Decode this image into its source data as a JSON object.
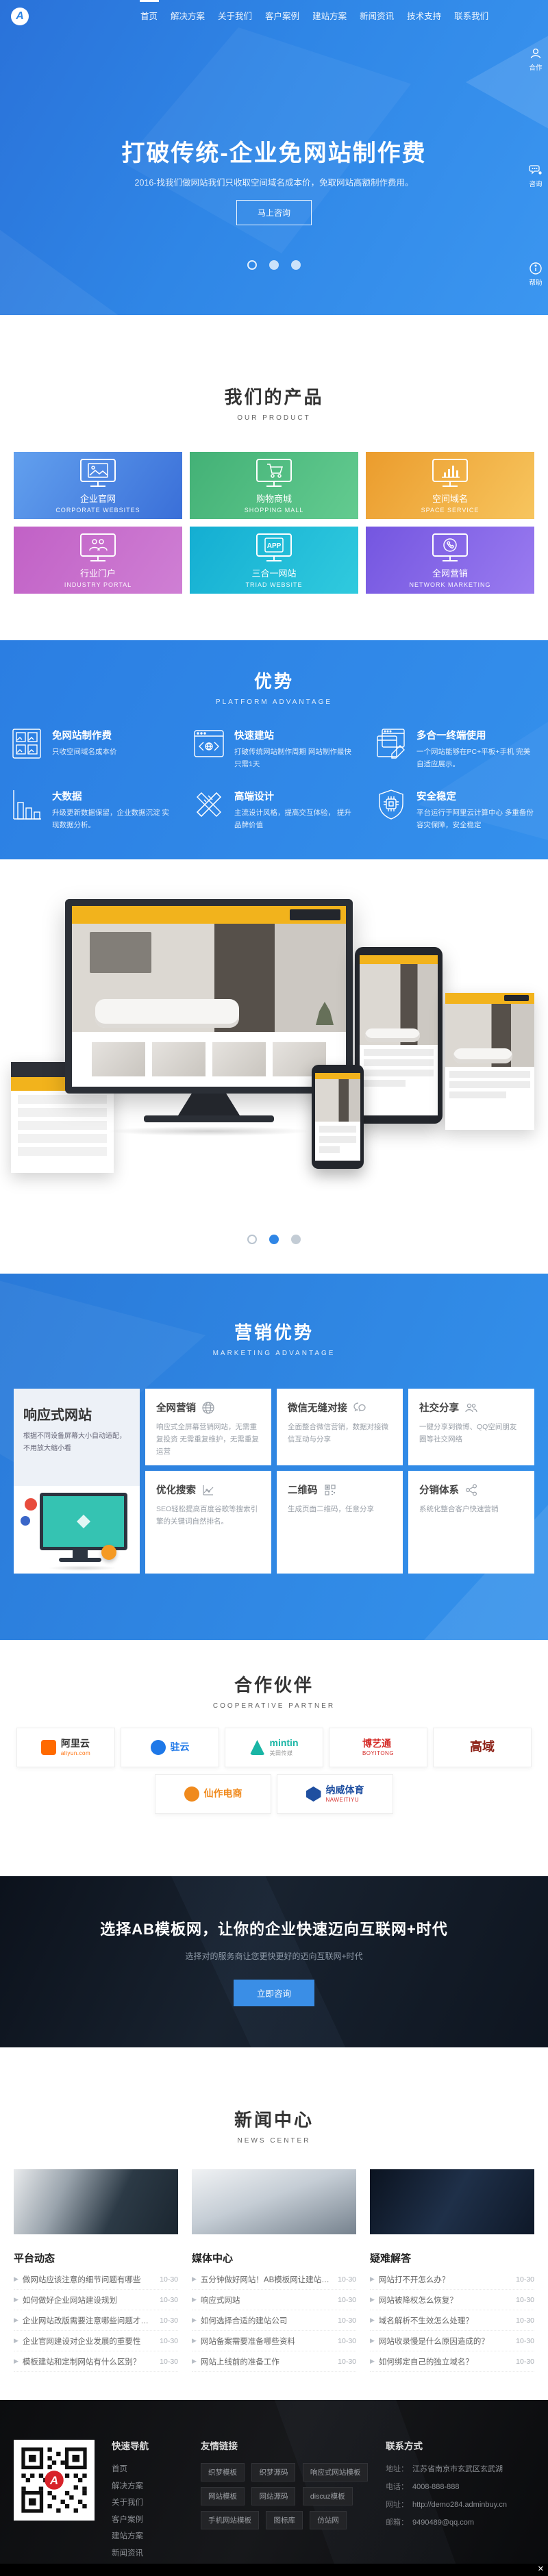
{
  "colors": {
    "primary": "#2f86e6",
    "accent_yellow": "#f2b31c",
    "cta_button": "#3a8ee6",
    "dark_footer": "#121316"
  },
  "header": {
    "logo_letter": "A",
    "nav": [
      {
        "label": "首页",
        "active": true
      },
      {
        "label": "解决方案",
        "active": false
      },
      {
        "label": "关于我们",
        "active": false
      },
      {
        "label": "客户案例",
        "active": false
      },
      {
        "label": "建站方案",
        "active": false
      },
      {
        "label": "新闻资讯",
        "active": false
      },
      {
        "label": "技术支持",
        "active": false
      },
      {
        "label": "联系我们",
        "active": false
      }
    ]
  },
  "side_toolbar": {
    "items": [
      {
        "icon": "user-icon",
        "label": "合作"
      },
      {
        "icon": "chat-icon",
        "label": "咨询"
      },
      {
        "icon": "info-icon",
        "label": "帮助"
      }
    ]
  },
  "hero": {
    "title": "打破传统-企业免网站制作费",
    "subtitle": "2016-找我们做网站我们只收取空间域名成本价，免取网站高额制作费用。",
    "cta": "马上咨询"
  },
  "products": {
    "title": "我们的产品",
    "subtitle": "OUR PRODUCT",
    "app_icon_label": "APP",
    "items": [
      {
        "zh": "企业官网",
        "en": "CORPORATE WEBSITES",
        "gradient": "linear-gradient(125deg,#62a0ee,#3a6fd8)"
      },
      {
        "zh": "购物商城",
        "en": "SHOPPING MALL",
        "gradient": "linear-gradient(125deg,#43b176,#63cb90)"
      },
      {
        "zh": "空间域名",
        "en": "SPACE SERVICE",
        "gradient": "linear-gradient(125deg,#eb9c2d,#f7c55e)"
      },
      {
        "zh": "行业门户",
        "en": "INDUSTRY PORTAL",
        "gradient": "linear-gradient(125deg,#c161c6,#cf7fd4)"
      },
      {
        "zh": "三合一网站",
        "en": "TRIAD WEBSITE",
        "gradient": "linear-gradient(125deg,#14aed2,#30cade)"
      },
      {
        "zh": "全网营销",
        "en": "NETWORK MARKETING",
        "gradient": "linear-gradient(125deg,#7456e0,#9a7bf0)"
      }
    ]
  },
  "advantages": {
    "title": "优势",
    "subtitle": "PLATFORM ADVANTAGE",
    "items": [
      {
        "title": "免网站制作费",
        "desc": "只收空间域名成本价"
      },
      {
        "title": "快速建站",
        "desc": "打破传统网站制作周期 网站制作最快只需1天"
      },
      {
        "title": "多合一终端使用",
        "desc": "一个网站能够在PC+平板+手机 完美自适应展示。"
      },
      {
        "title": "大数据",
        "desc": "升级更新数据保留，企业数据沉淀 实现数据分析。"
      },
      {
        "title": "高端设计",
        "desc": "主流设计风格，提高交互体验， 提升品牌价值"
      },
      {
        "title": "安全稳定",
        "desc": "平台运行于阿里云计算中心 多重备份容灾保障，安全稳定"
      }
    ]
  },
  "marketing": {
    "title": "营销优势",
    "subtitle": "MARKETING ADVANTAGE",
    "feature": {
      "title": "响应式网站",
      "desc": "根据不同设备屏幕大小自动适配，不用放大缩小看"
    },
    "cards": [
      {
        "icon": "globe-icon",
        "title": "全网营销",
        "desc": "响应式全屏幕营销网站，无需重复投资 无需重复维护，无需重复运营"
      },
      {
        "icon": "wechat-icon",
        "title": "微信无缝对接",
        "desc": "全面整合微信营销，数据对接微信互动与分享"
      },
      {
        "icon": "users-icon",
        "title": "社交分享",
        "desc": "一键分享到微博、QQ空间朋友圈等社交网络"
      },
      {
        "icon": "chart-line-icon",
        "title": "优化搜索",
        "desc": "SEO轻松提高百度谷歌等搜索引擎的关键词自然排名。"
      },
      {
        "icon": "qrcode-icon",
        "title": "二维码",
        "desc": "生成页面二维码，任意分享"
      },
      {
        "icon": "share-icon",
        "title": "分销体系",
        "desc": "系统化整合客户快速营销"
      }
    ]
  },
  "partners": {
    "title": "合作伙伴",
    "subtitle": "COOPERATIVE PARTNER",
    "logos": [
      {
        "name": "阿里云",
        "sub": "aliyun.com",
        "color": "#ff6a00"
      },
      {
        "name": "驻云",
        "sub": "",
        "color": "#1e78e8"
      },
      {
        "name": "mintin",
        "sub": "美田传媒",
        "color": "#19b5a5"
      },
      {
        "name": "博艺通",
        "sub": "BOYITONG",
        "color": "#d42b27"
      },
      {
        "name": "高域",
        "sub": "",
        "color": "#8c1f14"
      },
      {
        "name": "仙作电商",
        "sub": "",
        "color": "#f08a1d"
      },
      {
        "name": "纳威体育",
        "sub": "NAWEITIYU",
        "color": "#1f4fa0"
      }
    ]
  },
  "cta": {
    "title": "选择AB模板网，让你的企业快速迈向互联网+时代",
    "subtitle": "选择对的服务商让您更快更好的迈向互联网+时代",
    "button": "立即咨询"
  },
  "news": {
    "title": "新闻中心",
    "subtitle": "NEWS CENTER",
    "columns": [
      {
        "name": "平台动态",
        "photo": "linear-gradient(115deg,#e8eaec 0%,#9aa4ad 30%,#2c3a46 62%,#1b2630 100%)",
        "articles": [
          {
            "title": "做网站应该注意的细节问题有哪些",
            "date": "10-30"
          },
          {
            "title": "如何做好企业网站建设规划",
            "date": "10-30"
          },
          {
            "title": "企业网站改版需要注意哪些问题才不掉权重",
            "date": "10-30"
          },
          {
            "title": "企业官网建设对企业发展的重要性",
            "date": "10-30"
          },
          {
            "title": "模板建站和定制网站有什么区别？",
            "date": "10-30"
          }
        ]
      },
      {
        "name": "媒体中心",
        "photo": "linear-gradient(160deg,#f0f2f4 0%,#c5cdd5 45%,#76828e 100%)",
        "articles": [
          {
            "title": "五分钟做好网站！AB模板网让建站更简单",
            "date": "10-30"
          },
          {
            "title": "响应式网站",
            "date": "10-30"
          },
          {
            "title": "如何选择合适的建站公司",
            "date": "10-30"
          },
          {
            "title": "网站备案需要准备哪些资料",
            "date": "10-30"
          },
          {
            "title": "网站上线前的准备工作",
            "date": "10-30"
          }
        ]
      },
      {
        "name": "疑难解答",
        "photo": "linear-gradient(120deg,#0b1320 0%,#1f3049 50%,#0e1828 100%)",
        "articles": [
          {
            "title": "网站打不开怎么办？",
            "date": "10-30"
          },
          {
            "title": "网站被降权怎么恢复？",
            "date": "10-30"
          },
          {
            "title": "域名解析不生效怎么处理？",
            "date": "10-30"
          },
          {
            "title": "网站收录慢是什么原因造成的？",
            "date": "10-30"
          },
          {
            "title": "如何绑定自己的独立域名？",
            "date": "10-30"
          }
        ]
      }
    ]
  },
  "footer": {
    "nav_title": "快速导航",
    "nav": [
      "首页",
      "解决方案",
      "关于我们",
      "客户案例",
      "建站方案",
      "新闻资讯",
      "技术支持",
      "联系我们"
    ],
    "links_title": "友情链接",
    "links": [
      "织梦模板",
      "织梦源码",
      "响应式网站模板",
      "网站模板",
      "网站源码",
      "discuz模板",
      "手机网站模板",
      "图标库",
      "仿站网"
    ],
    "contact_title": "联系方式",
    "contact": [
      {
        "label": "地址：",
        "value": "江苏省南京市玄武区玄武湖"
      },
      {
        "label": "电话：",
        "value": "4008-888-888"
      },
      {
        "label": "网址：",
        "value": "http://demo284.adminbuy.cn"
      },
      {
        "label": "邮箱：",
        "value": "9490489@qq.com"
      }
    ],
    "logo_letter": "A"
  },
  "misc": {
    "close_glyph": "✕"
  }
}
